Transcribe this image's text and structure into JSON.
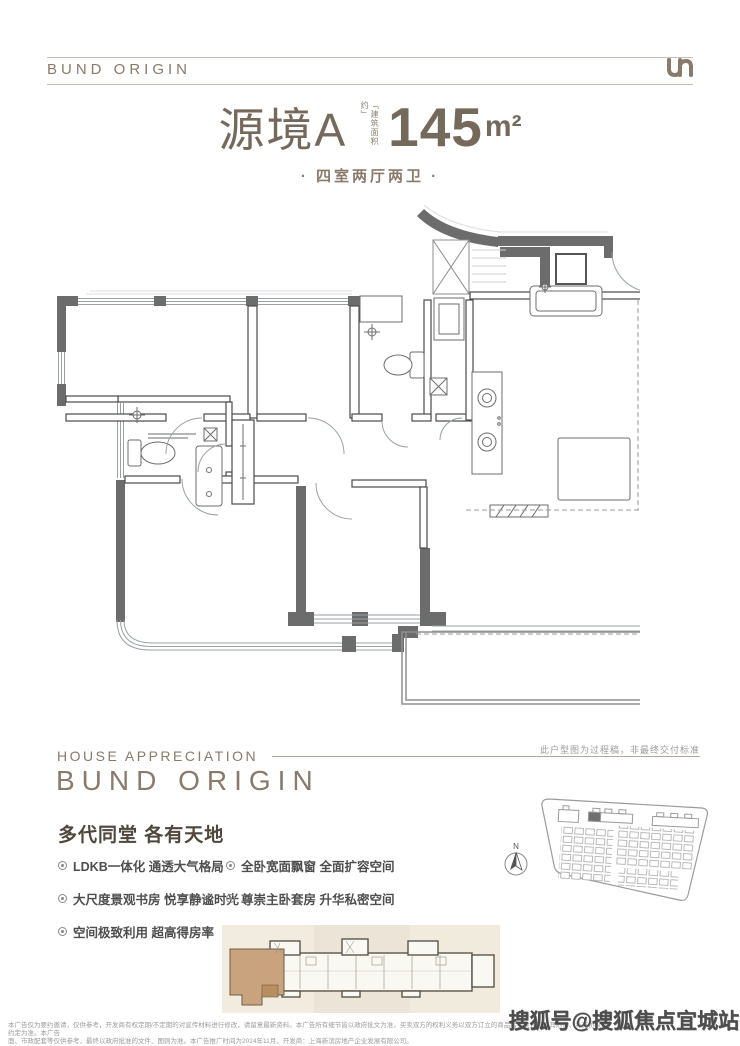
{
  "header": {
    "brand": "BUND ORIGIN"
  },
  "title": {
    "name": "源境A",
    "area_label": "「建筑面积约」",
    "area_value": "145",
    "area_unit": "m²",
    "subtitle": "· 四室两厅两卫 ·"
  },
  "plan": {
    "note": "此户型图为过程稿，非最终交付标准"
  },
  "section": {
    "eyebrow": "HOUSE APPRECIATION",
    "brand": "BUND ORIGIN",
    "heading": "多代同堂 各有天地",
    "features": [
      "LDKB一体化 通透大气格局",
      "全卧宽面飘窗 全面扩容空间",
      "大尺度景观书房 悦享静谧时光",
      "尊崇主卧套房 升华私密空间",
      "空间极致利用 超高得房率"
    ]
  },
  "siteplan": {
    "compass_label": "N"
  },
  "footer": {
    "disclaimer_line1": "本广告仅为要约邀请，仅供参考，开发商有权定期/不定期的对宣传材料进行修改，请留意最新资料。本广告所有细节皆以政府批文为准，买卖双方的权利义务以双方订立的商品房买卖合同及其附件、补充协议的约定为准。本广告",
    "disclaimer_line2": "面、市政配套等仅供参考，最终以政府批准的文件、图则为准。本广告推广时间为2024年11月，开发商：上海新滨房地产企业发展有限公司。",
    "watermark": "搜狐号@搜狐焦点宜城站"
  },
  "colors": {
    "brand": "#8a7a6b",
    "title": "#75695c",
    "wall": "#6c6c6c",
    "keyplan_highlight": "#c9a37d",
    "keyplan_bg": "#efe8da",
    "watermark": "#3e3e3e"
  }
}
